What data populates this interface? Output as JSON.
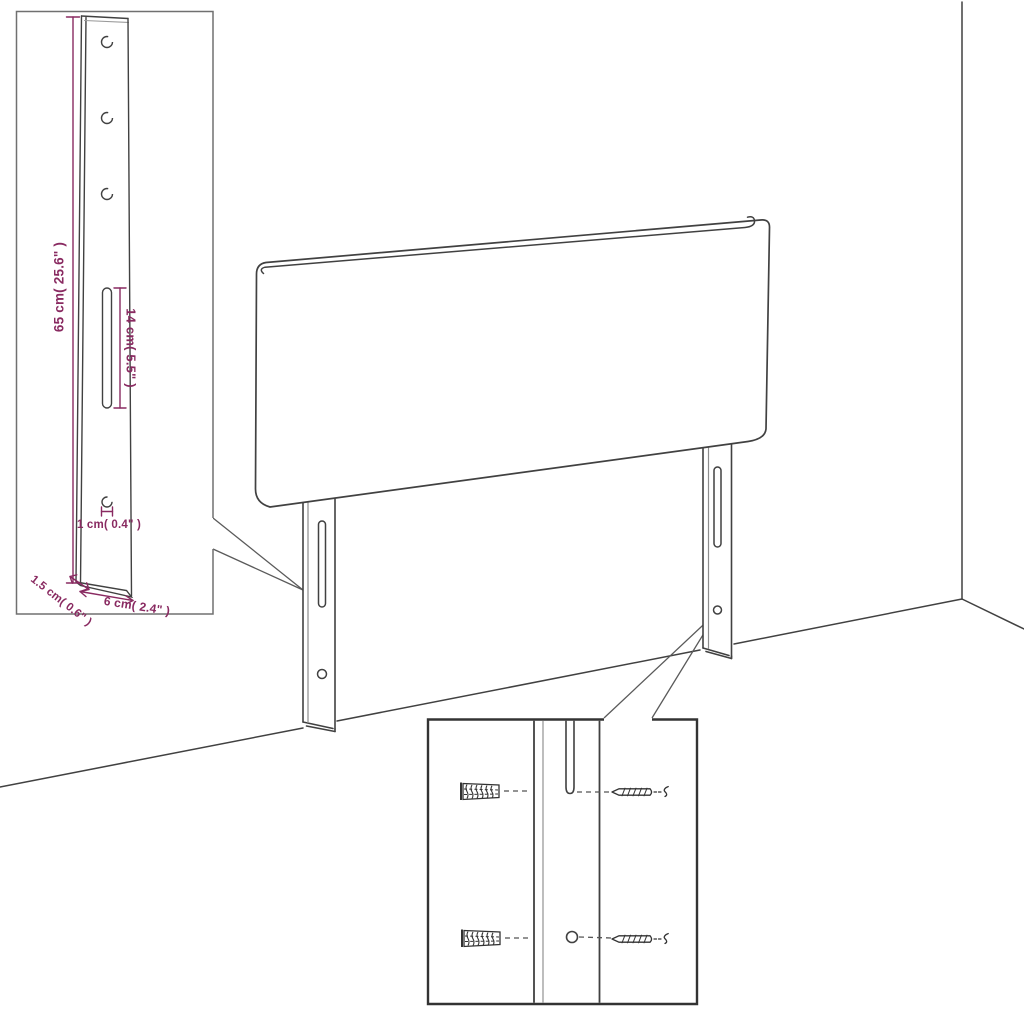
{
  "figure": {
    "type": "product-dimension-diagram",
    "product": "upholstered headboard with two wall-mount legs",
    "background_color": "#ffffff",
    "line_color": "#414141",
    "dimension_color": "#892a61"
  },
  "dimensions": {
    "leg_height": "65 cm( 25.6\" )",
    "slot_length": "14 cm( 5.5\" )",
    "hole_diameter": "1 cm( 0.4\" )",
    "leg_thickness": "1.5 cm( 0.6\" )",
    "leg_width": "6 cm( 2.4\" )"
  },
  "insets": {
    "leg_detail": "enlarged leg board with three holes, long slot and screw hole",
    "mounting_detail": "leg slot and hole with screws and wall plugs"
  }
}
